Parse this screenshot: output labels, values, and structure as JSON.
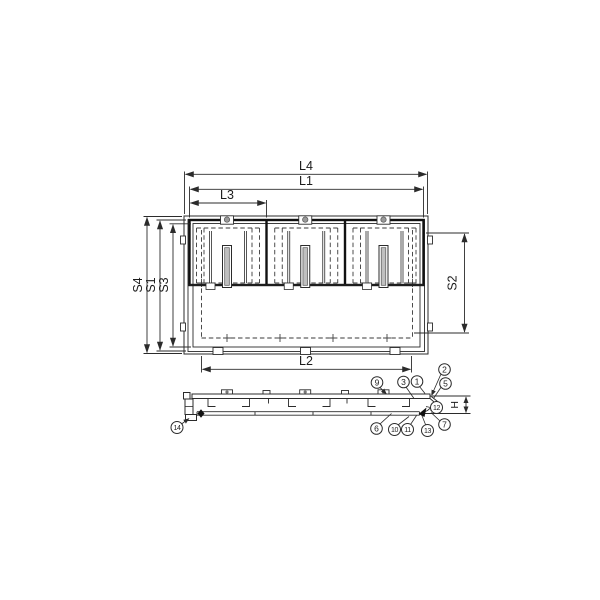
{
  "drawing": {
    "type": "technical-drawing-floor-hatch-3-covers",
    "dimension_labels": {
      "l4": "L4",
      "l1": "L1",
      "l3": "L3",
      "l2": "L2",
      "s4": "S4",
      "s1": "S1",
      "s3": "S3",
      "s2": "S2",
      "h": "H"
    },
    "part_balloons": [
      "1",
      "2",
      "3",
      "5",
      "6",
      "7",
      "9",
      "10",
      "11",
      "12",
      "13",
      "14"
    ],
    "colors": {
      "line": "#2b2b2b",
      "dashed_line": "#3a3a3a",
      "slot_fill": "#bfbfbf",
      "hinge_fill": "#9a9a9a",
      "background": "#ffffff"
    }
  }
}
